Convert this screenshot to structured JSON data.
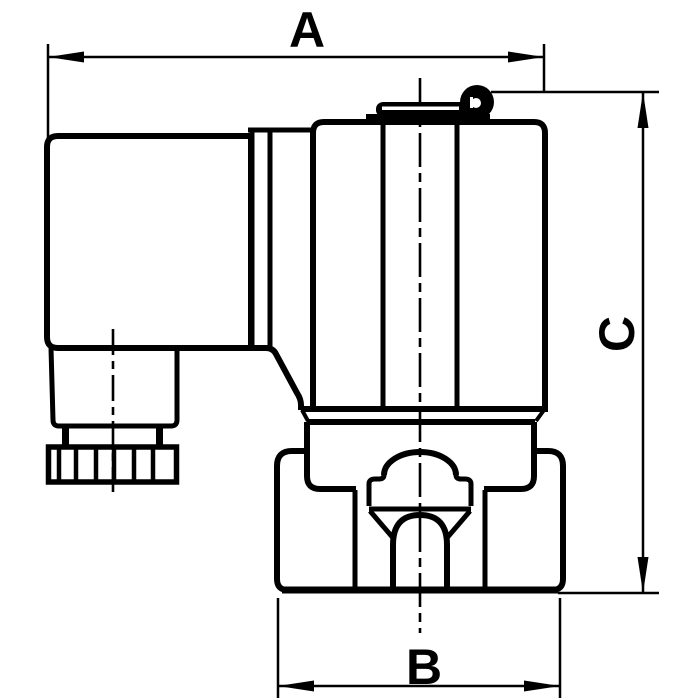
{
  "drawing": {
    "labels": {
      "width": "A",
      "port_width": "B",
      "height": "C"
    },
    "colors": {
      "line": "#000000",
      "background": "#ffffff"
    }
  }
}
